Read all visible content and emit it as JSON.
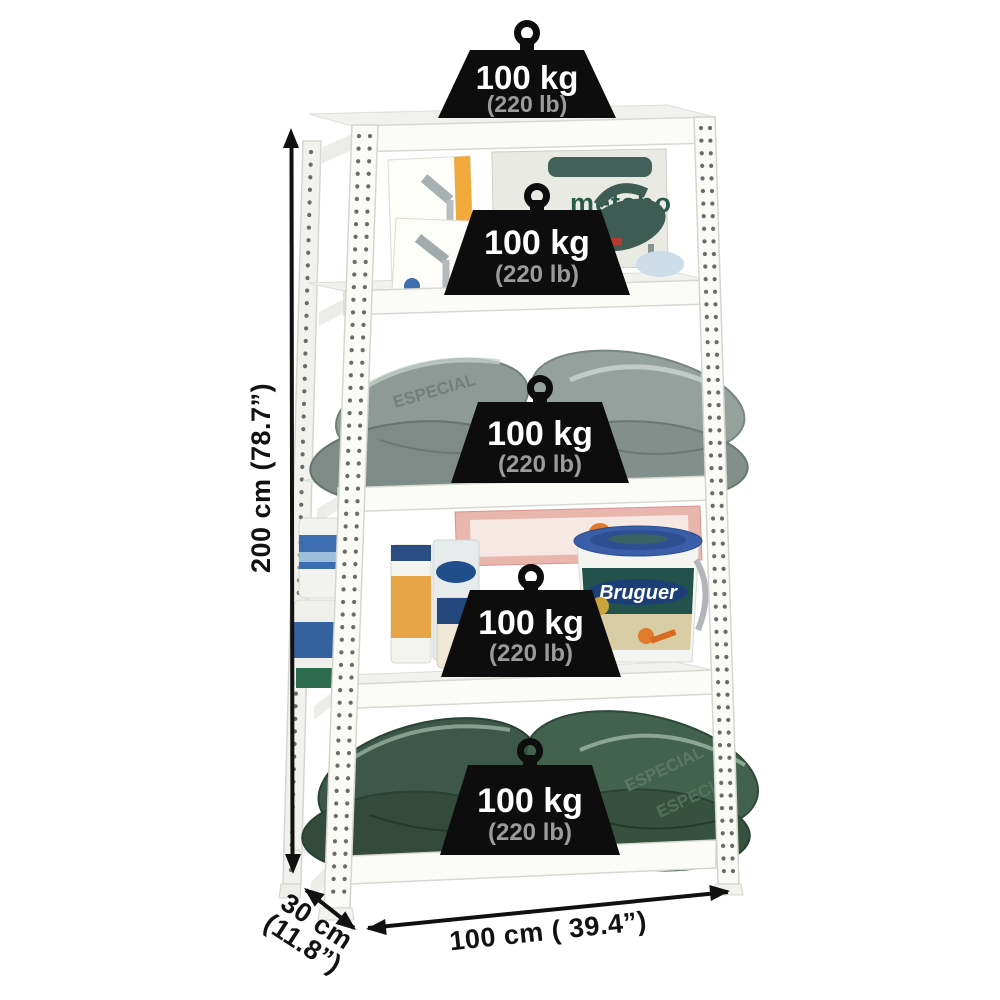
{
  "image_type": "product-dimension-photo",
  "product_text": {
    "metabo": "metabo",
    "bruguer": "Bruguer",
    "bag_print": "ESPECIAL"
  },
  "capacity_badges": [
    {
      "location": "top",
      "kg": "100 kg",
      "lb": "(220 lb)"
    },
    {
      "location": "shelf-1",
      "kg": "100 kg",
      "lb": "(220 lb)"
    },
    {
      "location": "shelf-2",
      "kg": "100 kg",
      "lb": "(220 lb)"
    },
    {
      "location": "shelf-3",
      "kg": "100 kg",
      "lb": "(220 lb)"
    },
    {
      "location": "shelf-4",
      "kg": "100 kg",
      "lb": "(220 lb)"
    }
  ],
  "dimensions": {
    "height": "200 cm (78.7”)",
    "depth_line1": "30 cm",
    "depth_line2": "(11.8”)",
    "width": "100 cm ( 39.4”)"
  },
  "colors": {
    "background": "#ffffff",
    "badge_fill": "#0d0d0d",
    "badge_kg_text": "#ffffff",
    "badge_lb_text": "#9b9b9b",
    "dimension_text": "#121212",
    "rack_metal": "#f8f8f5",
    "gray_bags": "#8e9a96",
    "green_bags": "#3d584a",
    "metabo_green": "#2c584a",
    "bruguer_navy": "#1d3f77",
    "accent_orange": "#efa33a"
  }
}
